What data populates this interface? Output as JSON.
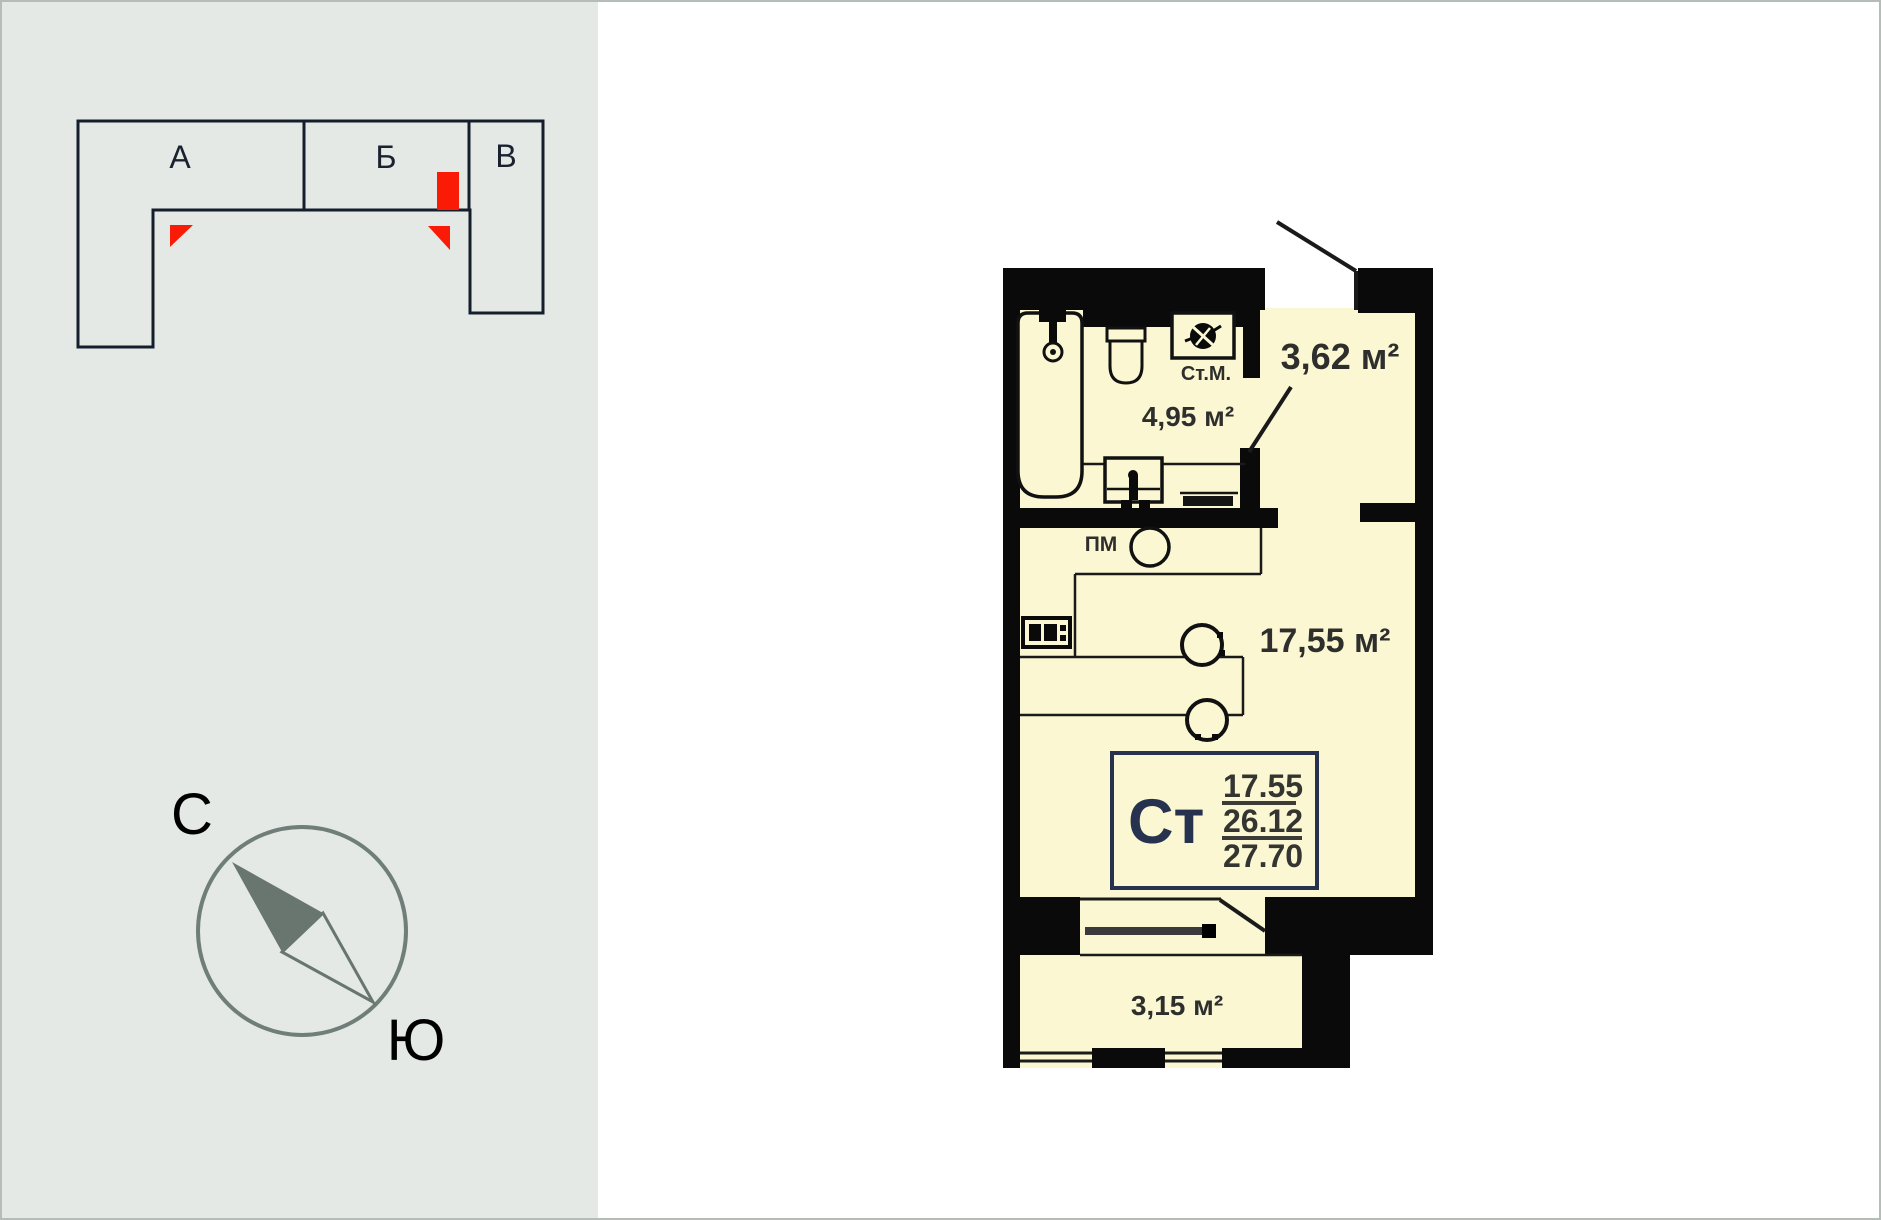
{
  "location_diagram": {
    "section_a": "А",
    "section_b": "Б",
    "section_c": "В"
  },
  "compass": {
    "north": "С",
    "south": "Ю"
  },
  "plan": {
    "hallway_area": "3,62 м²",
    "bathroom_area": "4,95 м²",
    "living_area": "17,55 м²",
    "balcony_area": "3,15 м²",
    "washing_machine": "Ст.М.",
    "dishwasher": "ПМ",
    "unit": {
      "type": "Ст",
      "living": "17.55",
      "area": "26.12",
      "total": "27.70"
    }
  },
  "colors": {
    "accent_red": "#F91B06",
    "floor": "#FAF7D2",
    "wall": "#0A0A0A",
    "info_navy": "#27324F",
    "compass_gray": "#6F7E79",
    "panel_bg": "#E4E9E6"
  }
}
